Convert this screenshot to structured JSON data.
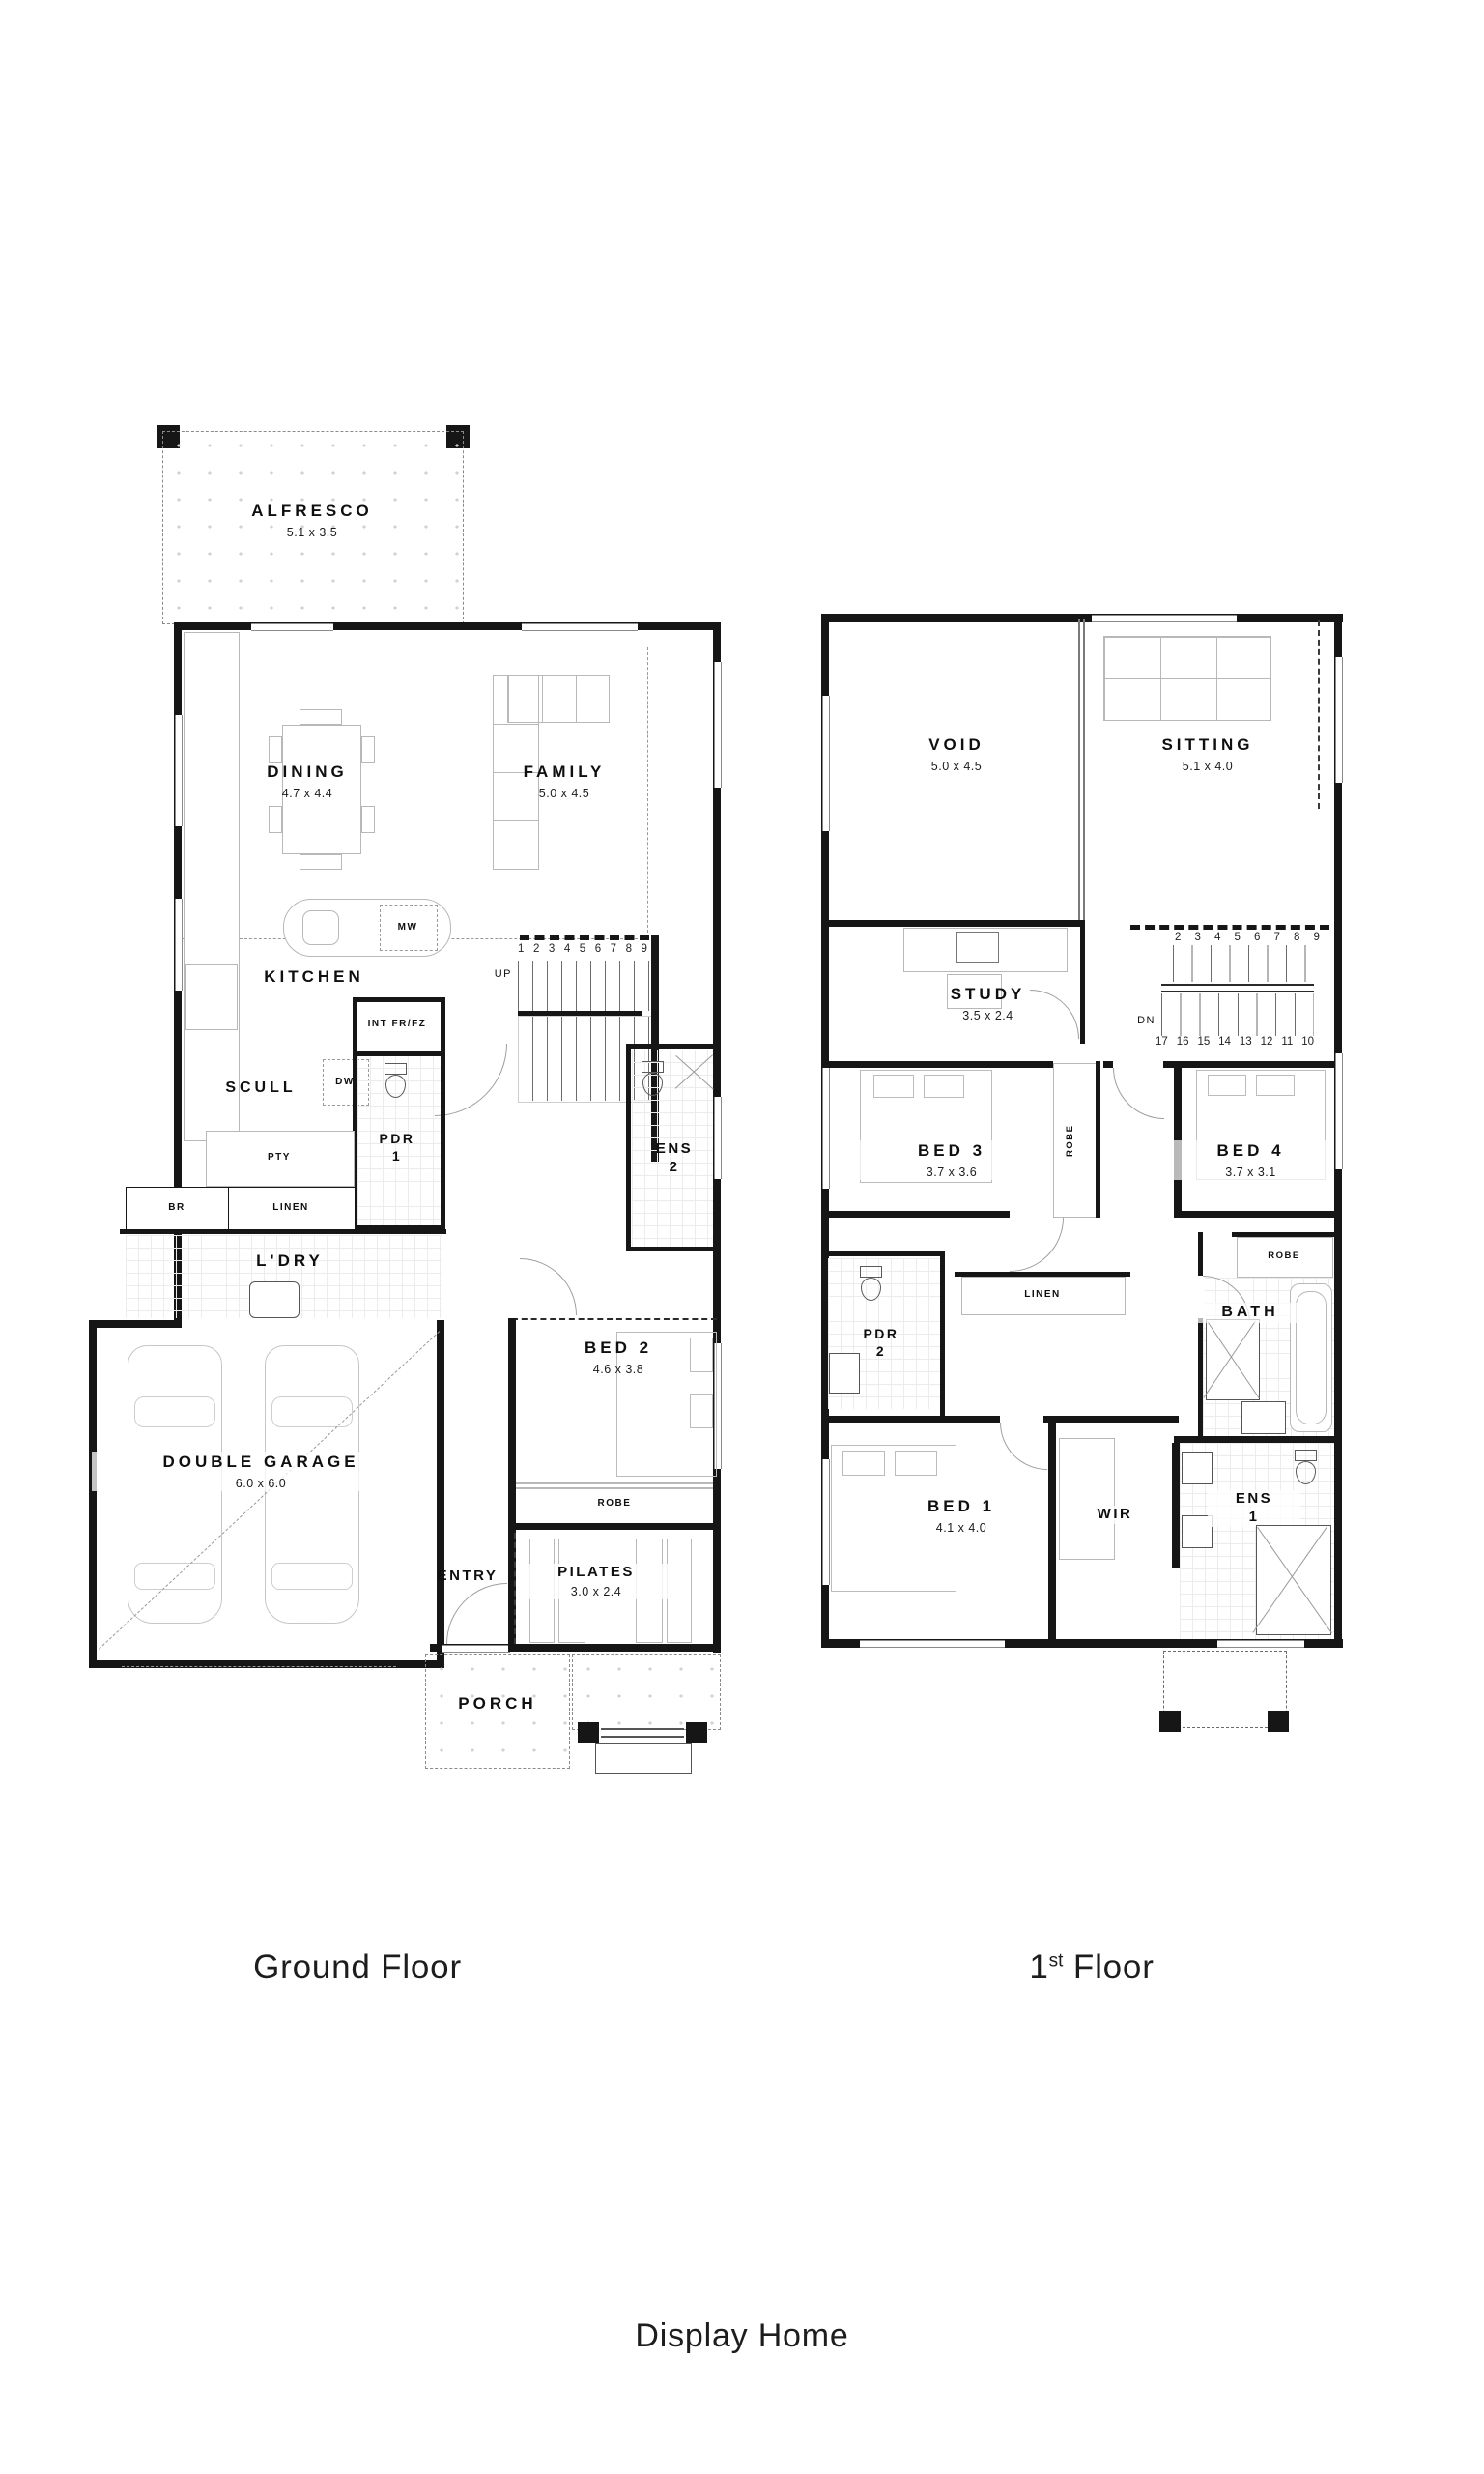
{
  "captions": {
    "ground_floor": "Ground Floor",
    "first_floor_number": "1",
    "first_floor_ordinal": "st",
    "first_floor_word": " Floor",
    "footer": "Display Home"
  },
  "ground_floor": {
    "alfresco": {
      "name": "ALFRESCO",
      "dims": "5.1 x 3.5"
    },
    "dining": {
      "name": "DINING",
      "dims": "4.7 x 4.4"
    },
    "family": {
      "name": "FAMILY",
      "dims": "5.0 x 4.5"
    },
    "kitchen": {
      "name": "KITCHEN",
      "microwave": "MW",
      "fridge": "INT FR/FZ"
    },
    "scullery": {
      "name": "SCULL",
      "dishwasher": "DW",
      "pantry": "PTY"
    },
    "store": {
      "broom": "BR",
      "linen": "LINEN"
    },
    "powder1": {
      "line1": "PDR",
      "line2": "1"
    },
    "ensuite2": {
      "line1": "ENS",
      "line2": "2"
    },
    "laundry": {
      "name": "L'DRY"
    },
    "bed2": {
      "name": "BED 2",
      "dims": "4.6 x 3.8",
      "robe": "ROBE"
    },
    "garage": {
      "name": "DOUBLE GARAGE",
      "dims": "6.0 x 6.0"
    },
    "entry": {
      "name": "ENTRY"
    },
    "pilates": {
      "name": "PILATES",
      "dims": "3.0 x 2.4"
    },
    "porch": {
      "name": "PORCH"
    },
    "stairs": {
      "up": "UP",
      "treads": [
        "1",
        "2",
        "3",
        "4",
        "5",
        "6",
        "7",
        "8",
        "9"
      ]
    }
  },
  "first_floor": {
    "void": {
      "name": "VOID",
      "dims": "5.0 x 4.5"
    },
    "sitting": {
      "name": "SITTING",
      "dims": "5.1 x 4.0"
    },
    "study": {
      "name": "STUDY",
      "dims": "3.5 x 2.4"
    },
    "bed3": {
      "name": "BED 3",
      "dims": "3.7 x 3.6"
    },
    "bed4": {
      "name": "BED 4",
      "dims": "3.7 x 3.1"
    },
    "bed1": {
      "name": "BED 1",
      "dims": "4.1 x 4.0"
    },
    "hall_robe": "ROBE",
    "bath": {
      "name": "BATH",
      "robe": "ROBE"
    },
    "powder2": {
      "line1": "PDR",
      "line2": "2"
    },
    "linen": "LINEN",
    "wir": {
      "name": "WIR"
    },
    "ensuite1": {
      "line1": "ENS",
      "line2": "1"
    },
    "stairs": {
      "down": "DN",
      "upper_treads": [
        "2",
        "3",
        "4",
        "5",
        "6",
        "7",
        "8",
        "9"
      ],
      "lower_treads": [
        "17",
        "16",
        "15",
        "14",
        "13",
        "12",
        "11",
        "10"
      ]
    }
  }
}
